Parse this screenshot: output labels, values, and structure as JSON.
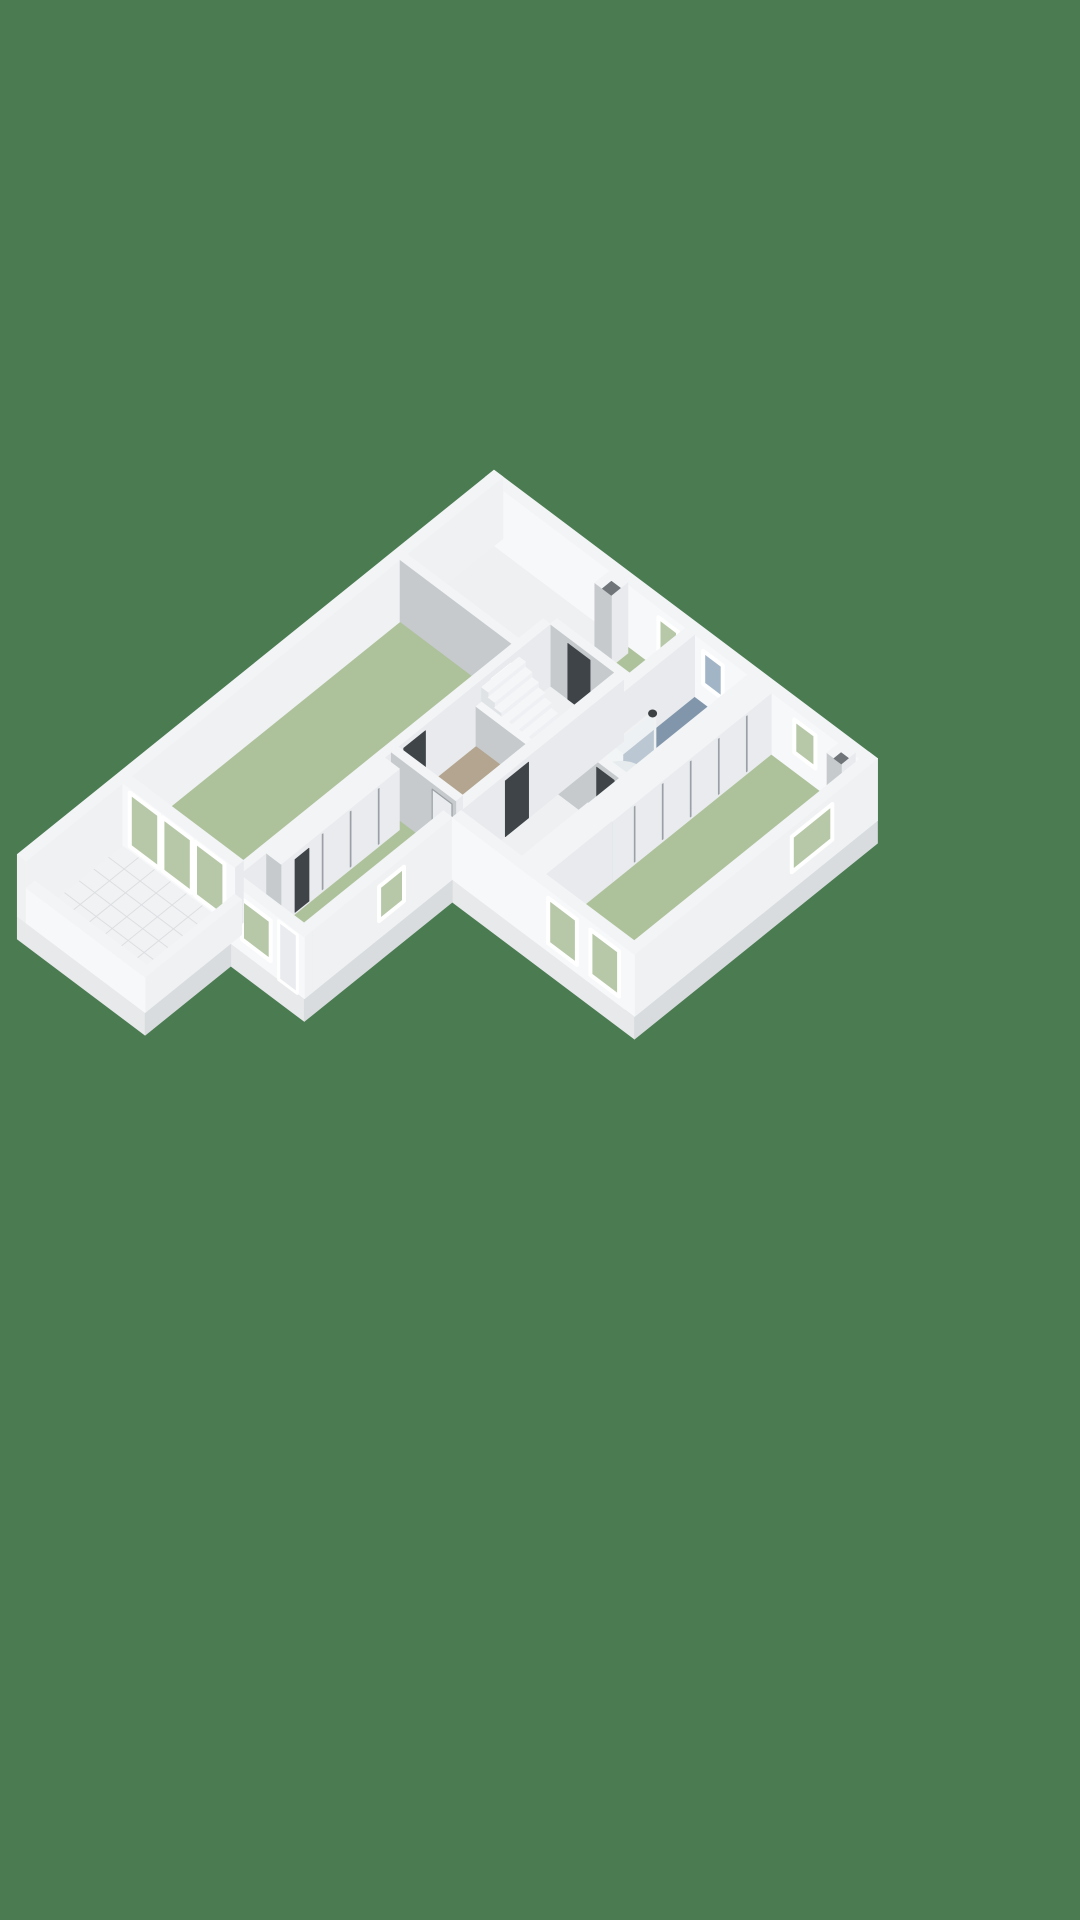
{
  "canvas": {
    "width": 1080,
    "height": 1920
  },
  "colors": {
    "bg": "#4a7b51",
    "slabTop": "#eef0f2",
    "slabSw": "#e7e9eb",
    "slabSe": "#d9dcdf",
    "wallTop": "#f2f4f6",
    "extBright": "#f7f8fa",
    "extLight": "#eff1f3",
    "intSw": "#c6cacd",
    "intSe": "#e8eaed",
    "floorGreen": "#adc29b",
    "floorBlue": "#8296ab",
    "floorTan": "#b3a58f",
    "tile": "#f1f2f4",
    "grout": "#dcdfe1",
    "glassGreen": "#b7c8a8",
    "glassBlue": "#a2b5c7",
    "frame": "#ffffff",
    "dark": "#3f4448",
    "darkInset": "#70757a",
    "gapLine": "#9aa0a5",
    "leaf": "#e9ebee",
    "balTop": "#f4f6f7",
    "stepTop": "#f4f6f7",
    "stepFront": "#eef0f3",
    "stepSide": "#e0e3e6",
    "washerBody": "#f0f2f3",
    "washerDoor": "#d9dde0",
    "tray": "#d8dfe3",
    "showerGlass": "rgba(244,247,249,0.5)",
    "knob": "#3c4043"
  },
  "scene": {
    "projection": {
      "ox": 494,
      "oy": 532,
      "ux": 31.96,
      "uy": 24.04,
      "vx": 31.16,
      "vy": 25.12,
      "hz": 41.3
    },
    "items": [
      {
        "t": "quad",
        "plane": "u",
        "at": 15.3,
        "r": [
          0,
          4.0
        ],
        "z": [
          -0.55,
          0
        ],
        "fill": "slabSw",
        "name": "slab-side"
      },
      {
        "t": "quad",
        "plane": "u",
        "at": 12.55,
        "r": [
          4.0,
          6.3
        ],
        "z": [
          -0.55,
          0
        ],
        "fill": "slabSw",
        "name": "slab-side"
      },
      {
        "t": "quad",
        "plane": "u",
        "at": 7.8,
        "r": [
          6.3,
          12
        ],
        "z": [
          -0.55,
          0
        ],
        "fill": "slabSw",
        "name": "slab-side"
      },
      {
        "t": "quad",
        "plane": "v",
        "at": 12,
        "r": [
          0,
          7.8
        ],
        "z": [
          -0.55,
          0
        ],
        "fill": "slabSe",
        "name": "slab-side"
      },
      {
        "t": "quad",
        "plane": "v",
        "at": 6.3,
        "r": [
          7.8,
          12.55
        ],
        "z": [
          -0.55,
          0
        ],
        "fill": "slabSe",
        "name": "slab-side"
      },
      {
        "t": "quad",
        "plane": "v",
        "at": 4.0,
        "r": [
          12.55,
          15.3
        ],
        "z": [
          -0.55,
          0
        ],
        "fill": "slabSe",
        "name": "slab-side"
      },
      {
        "t": "poly",
        "z": 0,
        "pts": [
          [
            0,
            0
          ],
          [
            12,
            0
          ],
          [
            12,
            7.8
          ],
          [
            6.3,
            7.8
          ],
          [
            6.3,
            12.55
          ],
          [
            4,
            12.55
          ],
          [
            4,
            15.3
          ],
          [
            0,
            15.3
          ]
        ],
        "fill": "slabTop",
        "name": "floor-slab"
      },
      {
        "t": "floor",
        "r": [
          4.0,
          0.28,
          6.27,
          2.08
        ],
        "fill": "floorGreen",
        "name": "top-room-floor"
      },
      {
        "t": "floor",
        "r": [
          6.55,
          0.28,
          8.2,
          4.18
        ],
        "fill": "floorBlue",
        "name": "bathroom-floor"
      },
      {
        "t": "floor",
        "r": [
          8.95,
          0.28,
          11.72,
          7.52
        ],
        "fill": "floorGreen",
        "name": "right-room-floor"
      },
      {
        "t": "floor",
        "r": [
          0.28,
          3.3,
          3.78,
          11.92
        ],
        "fill": "floorGreen",
        "name": "left-room-floor"
      },
      {
        "t": "floor",
        "r": [
          4.0,
          3.3,
          6.02,
          7.18
        ],
        "fill": "floorTan",
        "name": "hall-floor"
      },
      {
        "t": "floor",
        "r": [
          4.0,
          7.4,
          6.02,
          12.27
        ],
        "fill": "floorGreen",
        "name": "bottom-room-floor"
      },
      {
        "t": "tiles",
        "r": [
          0.28,
          12.2,
          3.78,
          15.02
        ],
        "fill": "tile",
        "grout": "grout",
        "du": 0.5,
        "dv": 0.47,
        "name": "terrace-floor"
      },
      {
        "t": "box",
        "r": [
          0,
          0,
          12,
          0.28
        ],
        "z": [
          0,
          1.5
        ],
        "top": "wallTop",
        "sw": "extBright",
        "se": "intSe",
        "name": "ne-facade-wall"
      },
      {
        "t": "quad",
        "plane": "u",
        "at": 0.28,
        "r": [
          5.42,
          6.03
        ],
        "z": [
          0.46,
          1.26
        ],
        "fill": "glassGreen",
        "stroke": "frame",
        "sw": 4,
        "name": "top-room-window"
      },
      {
        "t": "quad",
        "plane": "u",
        "at": 0.28,
        "r": [
          6.82,
          7.43
        ],
        "z": [
          0.46,
          1.26
        ],
        "fill": "glassBlue",
        "stroke": "frame",
        "sw": 4,
        "name": "bathroom-window"
      },
      {
        "t": "quad",
        "plane": "u",
        "at": 0.28,
        "r": [
          9.67,
          10.33
        ],
        "z": [
          0.46,
          1.26
        ],
        "fill": "glassGreen",
        "stroke": "frame",
        "sw": 4,
        "name": "right-room-window"
      },
      {
        "t": "box",
        "r": [
          0,
          0,
          0.28,
          15.3
        ],
        "z": [
          0,
          1.5
        ],
        "top": "wallTop",
        "sw": "extLight",
        "se": "extLight",
        "name": "nw-facade-wall"
      },
      {
        "t": "box",
        "r": [
          4.08,
          0.42,
          4.6,
          0.95
        ],
        "z": [
          0,
          1.72
        ],
        "top": "wallTop",
        "sw": "intSw",
        "se": "intSe",
        "name": "chimney"
      },
      {
        "t": "poly",
        "z": 1.58,
        "pts": [
          [
            4.2,
            0.54
          ],
          [
            4.48,
            0.54
          ],
          [
            4.48,
            0.83
          ],
          [
            4.2,
            0.83
          ]
        ],
        "fill": "darkInset",
        "name": "chimney-flue"
      },
      {
        "t": "box",
        "r": [
          11.15,
          0.3,
          11.6,
          0.75
        ],
        "z": [
          0,
          1.6
        ],
        "top": "wallTop",
        "sw": "intSw",
        "se": "intSe",
        "name": "duct-shaft"
      },
      {
        "t": "poly",
        "z": 1.46,
        "pts": [
          [
            11.26,
            0.41
          ],
          [
            11.49,
            0.41
          ],
          [
            11.49,
            0.64
          ],
          [
            11.26,
            0.64
          ]
        ],
        "fill": "darkInset",
        "name": "duct-shaft-opening"
      },
      {
        "t": "box",
        "r": [
          4.0,
          2.08,
          6.27,
          2.3
        ],
        "z": [
          0,
          1.5
        ],
        "name": "top-room-south-wall"
      },
      {
        "t": "quad",
        "plane": "u",
        "at": 2.3,
        "r": [
          4.55,
          5.25
        ],
        "z": [
          0,
          1.35
        ],
        "fill": "dark",
        "name": "top-room-door-opening"
      },
      {
        "t": "box",
        "r": [
          6.27,
          0.28,
          6.55,
          4.18
        ],
        "z": [
          0,
          1.5
        ],
        "name": "bathroom-west-wall"
      },
      {
        "t": "box",
        "r": [
          6.6,
          3.35,
          7.3,
          4.15
        ],
        "z": [
          0,
          0.92
        ],
        "top": "washerBody",
        "sw": "stepSide",
        "se": "washerBody",
        "name": "washing-machine"
      },
      {
        "t": "ellipse",
        "p": [
          7.3,
          3.75,
          0.46
        ],
        "rx": 10,
        "ry": 11,
        "fill": "washerDoor",
        "name": "washing-machine-door"
      },
      {
        "t": "ellipse",
        "p": [
          6.95,
          3.05,
          0.02
        ],
        "rx": 24,
        "ry": 14,
        "fill": "tray",
        "name": "shower-tray"
      },
      {
        "t": "quad",
        "plane": "v",
        "at": 7.38,
        "r": [
          2.4,
          4.12
        ],
        "z": [
          0,
          1.45
        ],
        "fill": "showerGlass",
        "stroke": "extLight",
        "sw": 2.5,
        "name": "shower-glass"
      },
      {
        "t": "ellipse",
        "p": [
          7.38,
          2.48,
          1.41
        ],
        "rx": 4.5,
        "ry": 4,
        "fill": "knob",
        "name": "shower-valve"
      },
      {
        "t": "box",
        "r": [
          6.3,
          4.18,
          8.2,
          4.4
        ],
        "z": [
          0,
          1.5
        ],
        "name": "bathroom-south-wall"
      },
      {
        "t": "quad",
        "plane": "u",
        "at": 4.4,
        "r": [
          7.5,
          8.05
        ],
        "z": [
          0,
          1.35
        ],
        "fill": "dark",
        "name": "bathroom-door-opening"
      },
      {
        "t": "box",
        "r": [
          0.28,
          3.08,
          3.78,
          3.3
        ],
        "z": [
          0,
          1.5
        ],
        "name": "left-room-north-wall"
      },
      {
        "t": "box",
        "r": [
          3.78,
          2.3,
          4.0,
          12.2
        ],
        "z": [
          0,
          1.5
        ],
        "name": "left-room-east-wall"
      },
      {
        "t": "quad",
        "plane": "v",
        "at": 4.0,
        "r": [
          3.55,
          4.15
        ],
        "z": [
          0.45,
          1.28
        ],
        "fill": "glassGreen",
        "stroke": "frame",
        "sw": 3.5,
        "name": "stairwell-window"
      },
      {
        "t": "quad",
        "plane": "v",
        "at": 4.0,
        "r": [
          6.3,
          7.0
        ],
        "z": [
          0,
          1.35
        ],
        "fill": "dark",
        "name": "left-room-door-opening"
      },
      {
        "t": "steps",
        "x0": 6.02,
        "n": 10,
        "d": 0.202,
        "y": [
          3.3,
          4.5
        ],
        "rise": 0.131,
        "name": "staircase"
      },
      {
        "t": "box",
        "r": [
          4.0,
          4.5,
          6.02,
          4.68
        ],
        "z": [
          0,
          0.95
        ],
        "top": "balTop",
        "name": "stair-balustrade"
      },
      {
        "t": "box",
        "r": [
          6.02,
          2.3,
          6.3,
          7.8
        ],
        "z": [
          0,
          1.5
        ],
        "name": "hall-east-wall"
      },
      {
        "t": "quad",
        "plane": "v",
        "at": 6.3,
        "r": [
          5.35,
          6.1
        ],
        "z": [
          0,
          1.35
        ],
        "fill": "dark",
        "name": "corridor-door-opening"
      },
      {
        "t": "box",
        "r": [
          8.2,
          0.28,
          8.95,
          5.4
        ],
        "z": [
          0,
          1.48
        ],
        "se": "leaf",
        "name": "right-room-closet"
      },
      {
        "t": "lines",
        "plane": "v",
        "at": 8.95,
        "ms": [
          1.05,
          1.95,
          2.85,
          3.75,
          4.65
        ],
        "w": 0.032,
        "z": [
          0.06,
          1.4
        ],
        "fill": "gapLine",
        "name": "closet-door-gap"
      },
      {
        "t": "box",
        "r": [
          8.2,
          5.4,
          8.95,
          7.52
        ],
        "z": [
          0,
          1.5
        ],
        "name": "right-room-west-wall"
      },
      {
        "t": "box",
        "r": [
          11.72,
          0,
          12,
          7.8
        ],
        "z": [
          0,
          1.5
        ],
        "top": "wallTop",
        "sw": "intSw",
        "se": "extLight",
        "name": "se-facade-wall"
      },
      {
        "t": "quad",
        "plane": "v",
        "at": 12,
        "r": [
          1.45,
          2.75
        ],
        "z": [
          0.42,
          1.28
        ],
        "fill": "glassGreen",
        "stroke": "frame",
        "sw": 4,
        "name": "right-room-side-window"
      },
      {
        "t": "box",
        "r": [
          4.0,
          7.18,
          6.02,
          7.4
        ],
        "z": [
          0,
          1.5
        ],
        "name": "bottom-room-north-wall"
      },
      {
        "t": "quad",
        "plane": "u",
        "at": 7.4,
        "r": [
          5.28,
          5.9
        ],
        "z": [
          0,
          1.35
        ],
        "fill": "leaf",
        "stroke": "gapLine",
        "sw": 1.2,
        "name": "bottom-room-door"
      },
      {
        "t": "box",
        "r": [
          4.0,
          7.6,
          4.45,
          11.4
        ],
        "z": [
          0,
          1.48
        ],
        "se": "leaf",
        "name": "bottom-room-closet"
      },
      {
        "t": "lines",
        "plane": "v",
        "at": 4.45,
        "ms": [
          8.25,
          9.15,
          10.05
        ],
        "w": 0.032,
        "z": [
          0.06,
          1.4
        ],
        "fill": "gapLine",
        "name": "closet-door-gap"
      },
      {
        "t": "quad",
        "plane": "v",
        "at": 4.45,
        "r": [
          10.5,
          10.95
        ],
        "z": [
          0.04,
          1.32
        ],
        "fill": "dark",
        "name": "closet-open-door"
      },
      {
        "t": "box",
        "r": [
          6.02,
          7.8,
          6.3,
          12.55
        ],
        "z": [
          0,
          1.5
        ],
        "top": "wallTop",
        "sw": "intSw",
        "se": "extLight",
        "name": "bottom-room-east-wall"
      },
      {
        "t": "quad",
        "plane": "v",
        "at": 6.3,
        "r": [
          9.35,
          10.15
        ],
        "z": [
          0.42,
          1.25
        ],
        "fill": "glassGreen",
        "stroke": "frame",
        "sw": 4,
        "name": "bottom-room-side-window"
      },
      {
        "t": "box",
        "r": [
          6.3,
          7.52,
          12,
          7.8
        ],
        "z": [
          0,
          1.5
        ],
        "top": "wallTop",
        "sw": "extBright",
        "se": "extLight",
        "name": "right-wing-front-wall"
      },
      {
        "t": "quad",
        "plane": "u",
        "at": 7.8,
        "r": [
          9.3,
          10.2
        ],
        "z": [
          0.2,
          1.3
        ],
        "fill": "glassGreen",
        "stroke": "frame",
        "sw": 4,
        "name": "right-room-front-window"
      },
      {
        "t": "quad",
        "plane": "u",
        "at": 7.8,
        "r": [
          10.62,
          11.52
        ],
        "z": [
          0.2,
          1.3
        ],
        "fill": "glassGreen",
        "stroke": "frame",
        "sw": 4,
        "name": "right-room-front-window"
      },
      {
        "t": "box",
        "r": [
          4.0,
          12.27,
          6.3,
          12.55
        ],
        "z": [
          0,
          1.5
        ],
        "top": "wallTop",
        "sw": "extBright",
        "se": "extLight",
        "name": "bottom-room-front-wall"
      },
      {
        "t": "quad",
        "plane": "u",
        "at": 12.55,
        "r": [
          4.35,
          5.25
        ],
        "z": [
          0.3,
          1.28
        ],
        "fill": "glassGreen",
        "stroke": "frame",
        "sw": 4,
        "name": "bottom-room-front-window"
      },
      {
        "t": "quad",
        "plane": "u",
        "at": 12.55,
        "r": [
          5.5,
          6.08
        ],
        "z": [
          0,
          1.42
        ],
        "fill": "leaf",
        "stroke": "frame",
        "sw": 3,
        "name": "back-door"
      },
      {
        "t": "box",
        "r": [
          0.28,
          11.92,
          3.78,
          12.2
        ],
        "z": [
          0,
          1.5
        ],
        "top": "wallTop",
        "sw": "extBright",
        "se": "intSe",
        "name": "terrace-wall"
      },
      {
        "t": "quad",
        "plane": "u",
        "at": 12.2,
        "r": [
          0.5,
          1.42
        ],
        "z": [
          0.1,
          1.4
        ],
        "fill": "glassGreen",
        "st​roke": "frame",
        "stroke": "frame",
        "sw": 4,
        "name": "terrace-door-glass"
      },
      {
        "t": "quad",
        "plane": "u",
        "at": 12.2,
        "r": [
          1.52,
          2.44
        ],
        "z": [
          0.1,
          1.4
        ],
        "fill": "glassGreen",
        "stroke": "frame",
        "sw": 4,
        "name": "terrace-door-glass"
      },
      {
        "t": "quad",
        "plane": "u",
        "at": 12.2,
        "r": [
          2.54,
          3.46
        ],
        "z": [
          0.1,
          1.4
        ],
        "fill": "glassGreen",
        "stroke": "frame",
        "sw": 4,
        "name": "terrace-door-glass"
      },
      {
        "t": "box",
        "r": [
          3.78,
          12.2,
          4.0,
          15.3
        ],
        "z": [
          0,
          0.85
        ],
        "top": "wallTop",
        "sw": "extBright",
        "se": "extLight",
        "name": "terrace-parapet"
      },
      {
        "t": "box",
        "r": [
          0.28,
          15.02,
          4.0,
          15.3
        ],
        "z": [
          0,
          0.85
        ],
        "top": "wallTop",
        "sw": "extBright",
        "se": "extLight",
        "name": "terrace-parapet"
      }
    ]
  }
}
